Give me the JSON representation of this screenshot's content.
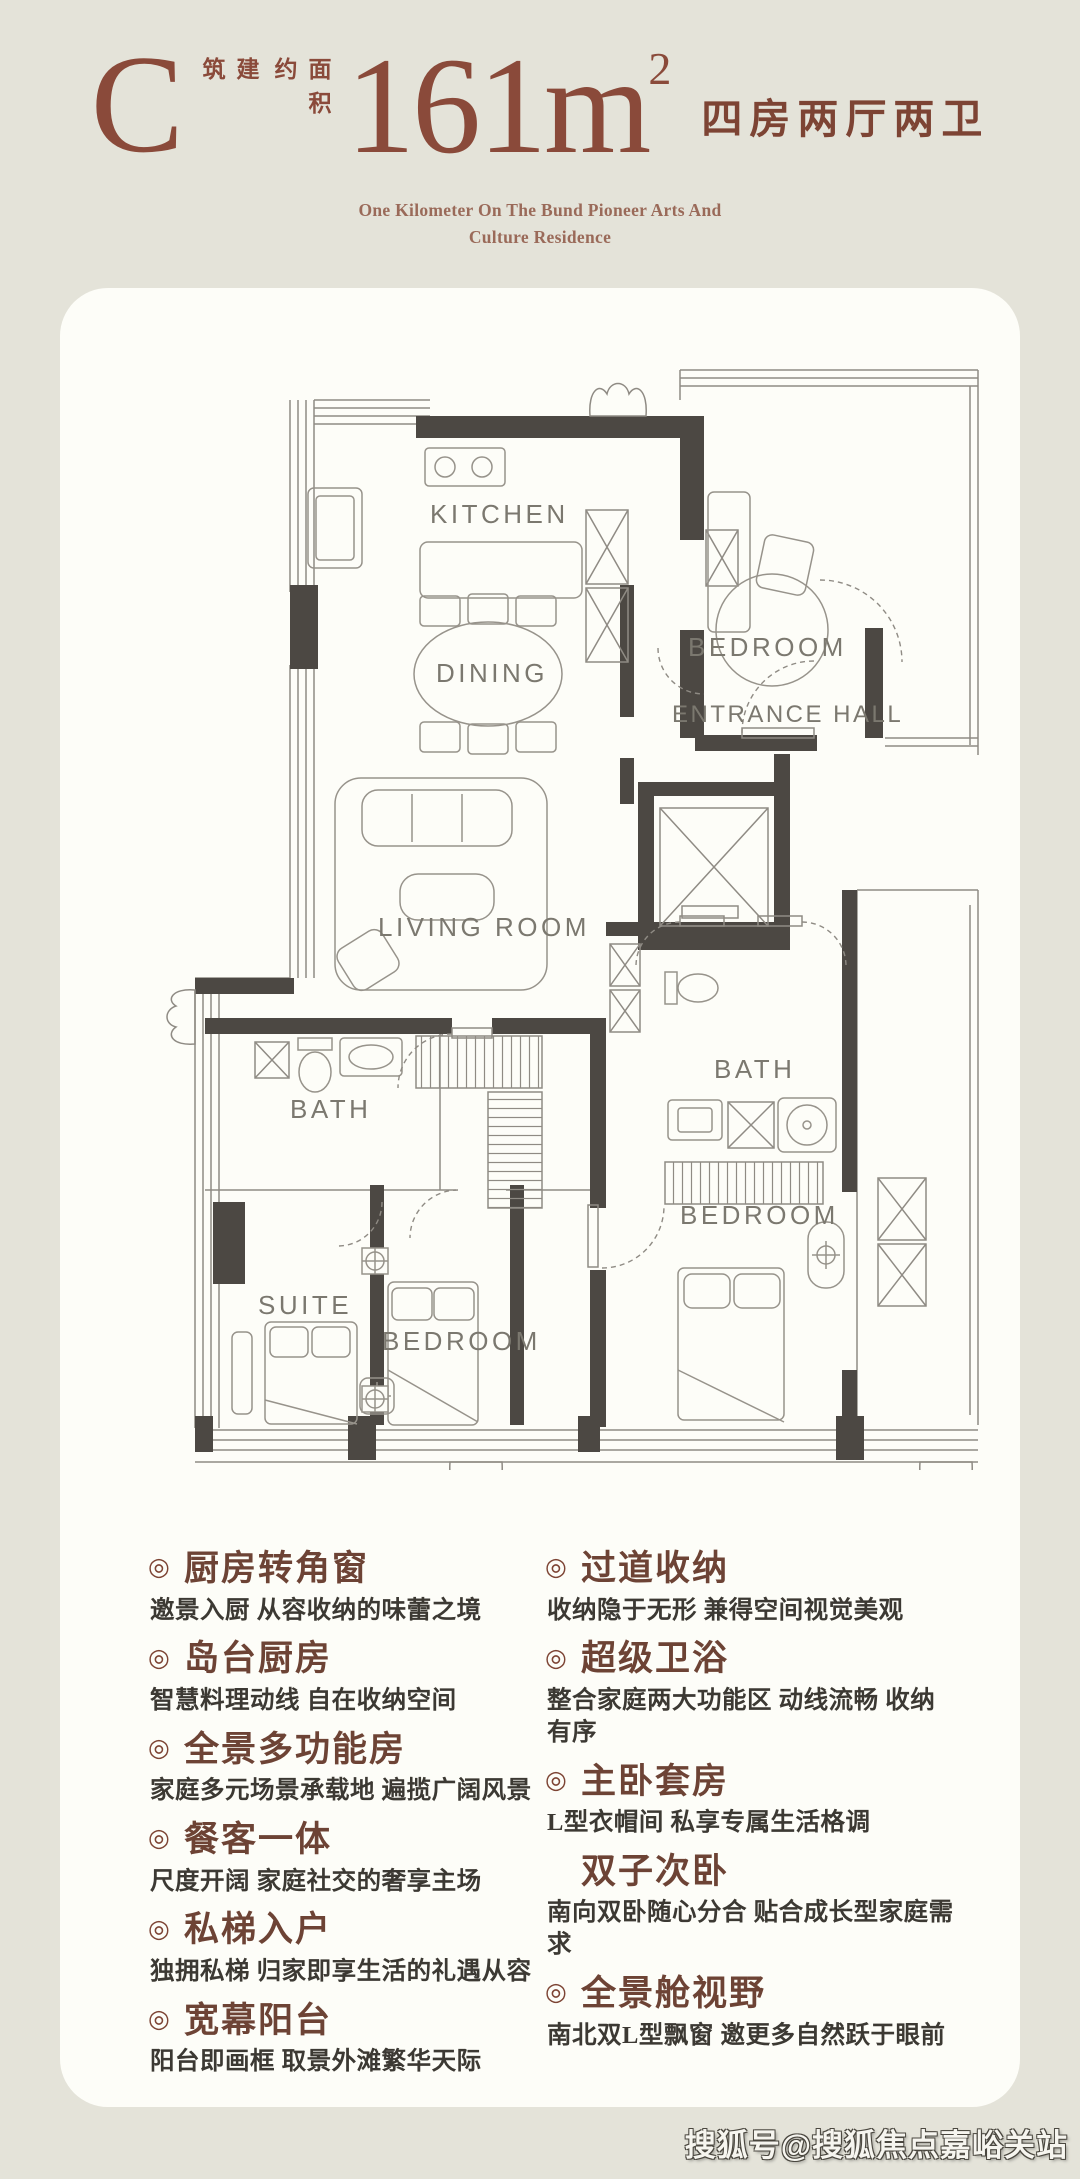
{
  "palette": {
    "page_bg": "#e4e3d9",
    "card_bg": "#fdfdf8",
    "accent_maroon": "#8a4a3a",
    "title_brown": "#6d4335",
    "desc_gray": "#3c3933",
    "plan_wall": "#4c4843",
    "plan_line": "#8f8b84"
  },
  "header": {
    "unit_letter": "C",
    "area_label_col1": "建筑",
    "area_label_col2": "面积约",
    "area_value": "161m",
    "area_sup": "2",
    "layout_label": "四房两厅两卫",
    "subtitle_line1": "One Kilometer On The Bund Pioneer Arts And",
    "subtitle_line2": "Culture Residence"
  },
  "floorplan": {
    "kitchen": "KITCHEN",
    "dining": "DINING",
    "bedroom_top": "BEDROOM",
    "entrance_hall": "ENTRANCE HALL",
    "living_room": "LIVING ROOM",
    "bath_left": "BATH",
    "bath_right": "BATH",
    "suite": "SUITE",
    "bedroom_mid": "BEDROOM",
    "bedroom_right": "BEDROOM"
  },
  "features": {
    "left": [
      {
        "bullet": "◎",
        "title": "厨房转角窗",
        "desc": "邀景入厨 从容收纳的味蕾之境"
      },
      {
        "bullet": "◎",
        "title": "岛台厨房",
        "desc": "智慧料理动线 自在收纳空间"
      },
      {
        "bullet": "◎",
        "title": "全景多功能房",
        "desc": "家庭多元场景承载地 遍揽广阔风景"
      },
      {
        "bullet": "◎",
        "title": "餐客一体",
        "desc": "尺度开阔 家庭社交的奢享主场"
      },
      {
        "bullet": "◎",
        "title": "私梯入户",
        "desc": "独拥私梯 归家即享生活的礼遇从容"
      },
      {
        "bullet": "◎",
        "title": "宽幕阳台",
        "desc": "阳台即画框 取景外滩繁华天际"
      }
    ],
    "right": [
      {
        "bullet": "◎",
        "title": "过道收纳",
        "desc": "收纳隐于无形 兼得空间视觉美观"
      },
      {
        "bullet": "◎",
        "title": "超级卫浴",
        "desc": "整合家庭两大功能区 动线流畅 收纳有序"
      },
      {
        "bullet": "◎",
        "title": "主卧套房",
        "desc": "L型衣帽间 私享专属生活格调"
      },
      {
        "bullet": "",
        "title": "双子次卧",
        "desc": "南向双卧随心分合 贴合成长型家庭需求"
      },
      {
        "bullet": "◎",
        "title": "全景舱视野",
        "desc": "南北双L型飘窗 邀更多自然跃于眼前"
      }
    ]
  },
  "watermark": {
    "text": "搜狐号@搜狐焦点嘉峪关站"
  }
}
